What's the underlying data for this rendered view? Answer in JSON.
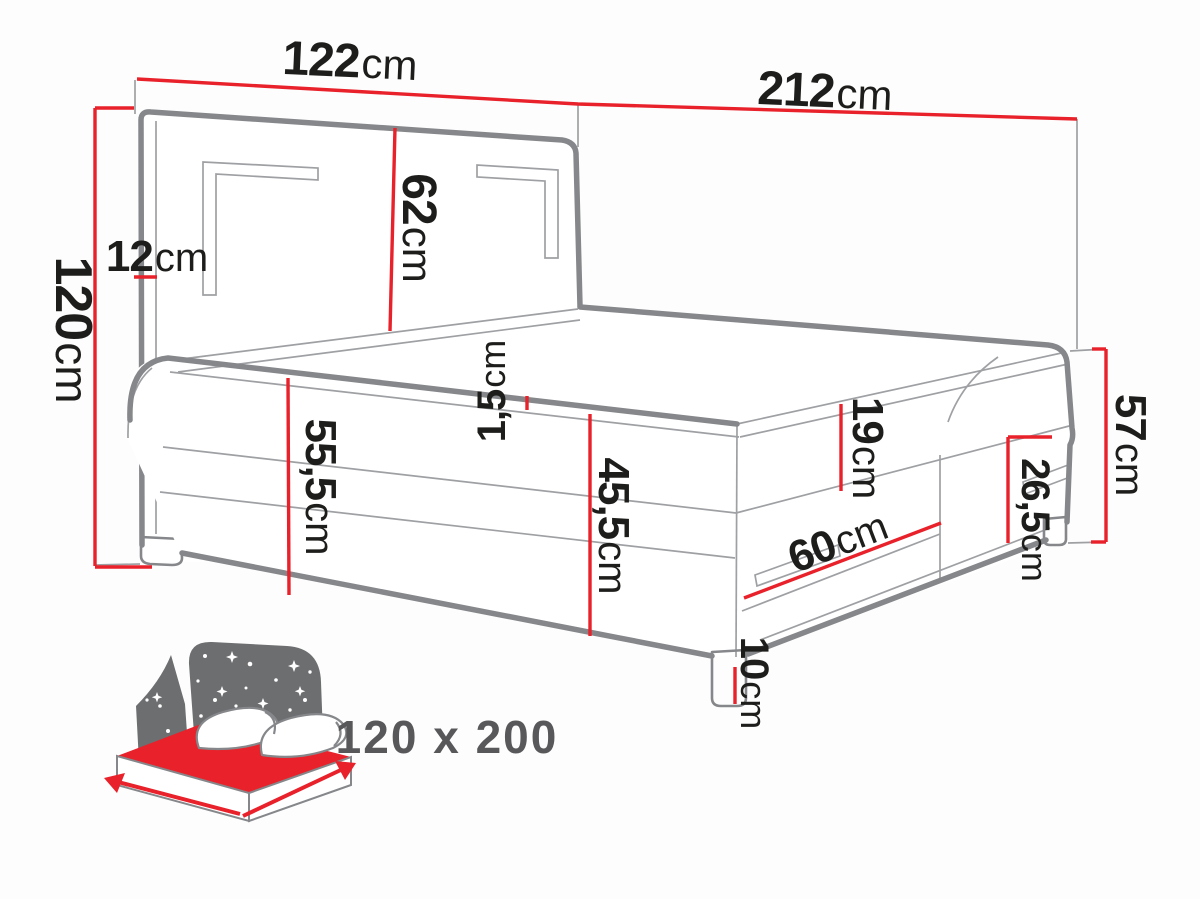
{
  "meta": {
    "title": "Boxspring bed dimension diagram"
  },
  "colors": {
    "dimension_red": "#e8212a",
    "outline_gray": "#85878a",
    "thin_gray": "#9ea0a3",
    "text_dark": "#1d1d1b",
    "badge_gray": "#58585a",
    "icon_gray": "#6d6e70",
    "background": "#fdfdfd"
  },
  "dimensions": {
    "headboard_width": {
      "value": "122",
      "unit": "cm"
    },
    "bed_length": {
      "value": "212",
      "unit": "cm"
    },
    "headboard_depth": {
      "value": "12",
      "unit": "cm"
    },
    "total_height": {
      "value": "120",
      "unit": "cm"
    },
    "headboard_above": {
      "value": "62",
      "unit": "cm"
    },
    "topper_lip": {
      "value": "1,5",
      "unit": "cm"
    },
    "side_height": {
      "value": "55,5",
      "unit": "cm"
    },
    "base_height": {
      "value": "45,5",
      "unit": "cm"
    },
    "mattress_height": {
      "value": "19",
      "unit": "cm"
    },
    "drawer_width": {
      "value": "60",
      "unit": "cm"
    },
    "box_height": {
      "value": "26,5",
      "unit": "cm"
    },
    "foot_end_height": {
      "value": "57",
      "unit": "cm"
    },
    "leg_height": {
      "value": "10",
      "unit": "cm"
    }
  },
  "size_badge": {
    "label": "120 x 200"
  }
}
